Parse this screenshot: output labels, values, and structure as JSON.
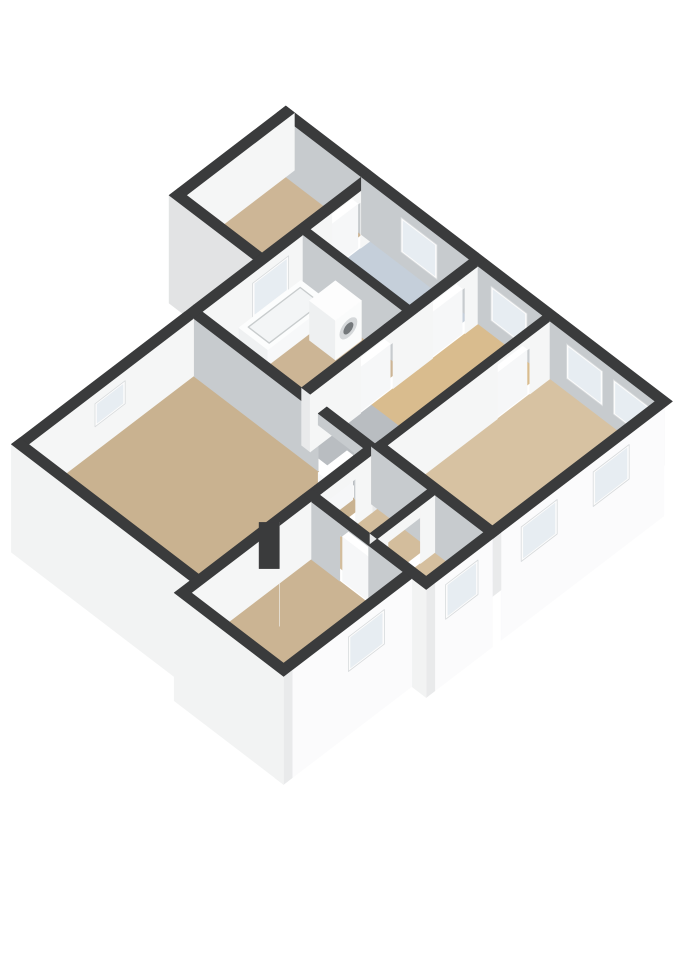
{
  "scene": {
    "width": 679,
    "height": 960,
    "projection": {
      "ox": 370,
      "oy": 228,
      "ax": 0.72,
      "ay": 0.55,
      "az": 0.72
    },
    "wall_height": 80,
    "slab_depth": 70,
    "door_height": 62,
    "colors": {
      "bg": "#ffffff",
      "top": "#3a3b3c",
      "innerGray": "#c7cbce",
      "innerWhite": "#f5f6f6",
      "extX": "#fbfbfc",
      "extY": "#f2f3f3",
      "aExt": "#e2e3e4",
      "cap": "#e9eaeb",
      "frame": "#fcfcfc",
      "glass": "#e7edf2",
      "tub": "#fcfdfd",
      "tubSide": "#eff1f2",
      "tubSideL": "#f7f8f9",
      "basin": "#f3f5f6",
      "basinLine": "#c8cccd",
      "washer": "#fafbfb",
      "washerSide": "#eef0f1",
      "washerTop": "#fdfdfd",
      "ring": "#d5d8da",
      "ringInner": "#74787b",
      "boxSide": "#f0f1f2",
      "boxSideL": "#f8f9f9",
      "boxTop": "#fdfdfd",
      "leafSide": "#f6f7f8",
      "leafTop": "#ffffff"
    },
    "floors": [
      {
        "name": "bedroom-top-left",
        "r": [
          -105,
          12,
          0,
          150
        ],
        "c": "#cdb696"
      },
      {
        "name": "bathroom-blue",
        "r": [
          12,
          12,
          150,
          95
        ],
        "c": "#c5cfda"
      },
      {
        "name": "bathroom-tub",
        "r": [
          12,
          105,
          150,
          245
        ],
        "c": "#ccb595"
      },
      {
        "name": "hallway-north",
        "r": [
          162,
          12,
          252,
          160
        ],
        "c": "#d9bc8e"
      },
      {
        "name": "landing-gray",
        "r": [
          162,
          160,
          252,
          245
        ],
        "c": "#b9bdc1"
      },
      {
        "name": "bedroom-right",
        "r": [
          262,
          12,
          408,
          238
        ],
        "c": "#d7c2a2"
      },
      {
        "name": "room-se-small-1",
        "r": [
          260,
          250,
          330,
          330
        ],
        "c": "#d3bd9c"
      },
      {
        "name": "room-se-small-2",
        "r": [
          340,
          250,
          408,
          330
        ],
        "c": "#d5bf9e"
      },
      {
        "name": "bedroom-bottom",
        "r": [
          260,
          342,
          388,
          508
        ],
        "c": "#cbb493"
      },
      {
        "name": "living-room",
        "r": [
          12,
          257,
          248,
          486
        ],
        "c": "#c9b290"
      }
    ],
    "walls": [
      {
        "n": "ne-wall-wing",
        "r": [
          -117,
          0,
          0,
          12
        ],
        "f": "innerGray"
      },
      {
        "n": "nw-wall-wing",
        "r": [
          -117,
          0,
          -105,
          150
        ],
        "f": "innerWhite"
      },
      {
        "n": "sw-wall-wing",
        "r": [
          -117,
          150,
          0,
          162
        ],
        "z": [
          -70,
          80
        ],
        "f": "aExt",
        "cap": true
      },
      {
        "n": "sw-wing-corner",
        "r": [
          0,
          150,
          12,
          162
        ],
        "f": "aExt"
      },
      {
        "n": "ne-wall-1",
        "r": [
          0,
          0,
          150,
          12
        ],
        "f": "innerGray",
        "win": [
          {
            "s": 55,
            "e": 105
          }
        ]
      },
      {
        "n": "ne-wall-j1",
        "r": [
          150,
          0,
          162,
          12
        ],
        "f": "innerGray"
      },
      {
        "n": "ne-wall-2",
        "r": [
          162,
          0,
          252,
          12
        ],
        "f": "innerGray",
        "win": [
          {
            "s": 180,
            "e": 230
          }
        ]
      },
      {
        "n": "ne-wall-j2",
        "r": [
          252,
          0,
          262,
          12
        ],
        "f": "innerGray"
      },
      {
        "n": "ne-wall-3",
        "r": [
          262,
          0,
          420,
          12
        ],
        "f": "innerGray",
        "win": [
          {
            "s": 285,
            "e": 335
          },
          {
            "s": 350,
            "e": 400
          }
        ]
      },
      {
        "n": "nw-wall-1",
        "r": [
          0,
          12,
          12,
          25
        ],
        "f": "innerWhite"
      },
      {
        "n": "nw-wall-door-header",
        "r": [
          0,
          25,
          12,
          65
        ],
        "z": [
          64,
          80
        ],
        "f": "innerWhite"
      },
      {
        "n": "nw-wall-2",
        "r": [
          0,
          65,
          12,
          95
        ],
        "f": "innerWhite"
      },
      {
        "n": "nw-wall-3",
        "r": [
          0,
          95,
          12,
          105
        ],
        "f": "innerWhite"
      },
      {
        "n": "nw-wall-4",
        "r": [
          0,
          105,
          12,
          245
        ],
        "f": "innerWhite",
        "win": [
          {
            "s": 125,
            "e": 175
          }
        ]
      },
      {
        "n": "nw-wall-5",
        "r": [
          0,
          245,
          12,
          257
        ],
        "f": "innerWhite"
      },
      {
        "n": "nw-wall-6",
        "r": [
          0,
          257,
          12,
          486
        ],
        "f": "innerWhite",
        "win": [
          {
            "s": 352,
            "e": 394,
            "z": [
              34,
              66
            ]
          }
        ]
      },
      {
        "n": "nw-wall-7",
        "r": [
          0,
          486,
          12,
          498
        ],
        "f": "innerWhite"
      },
      {
        "n": "se-wall-1",
        "r": [
          408,
          12,
          420,
          238
        ],
        "z": [
          -70,
          80
        ],
        "f": "extX",
        "win": [
          {
            "s": 60,
            "e": 110
          },
          {
            "s": 160,
            "e": 210
          }
        ]
      },
      {
        "n": "se-wall-j",
        "r": [
          408,
          238,
          420,
          250
        ],
        "z": [
          -70,
          80
        ],
        "f": "extX"
      },
      {
        "n": "se-wall-2",
        "r": [
          408,
          250,
          420,
          330
        ],
        "z": [
          -70,
          80
        ],
        "f": "extX",
        "win": [
          {
            "s": 270,
            "e": 315
          }
        ],
        "cap": true
      },
      {
        "n": "se-step-wall",
        "r": [
          400,
          330,
          420,
          342
        ],
        "z": [
          -70,
          80
        ],
        "f": "extY",
        "cap": true
      },
      {
        "n": "d-north-1",
        "r": [
          250,
          330,
          300,
          342
        ],
        "f": "innerGray"
      },
      {
        "n": "d-north-header",
        "r": [
          300,
          330,
          340,
          342
        ],
        "z": [
          64,
          80
        ],
        "f": "innerGray"
      },
      {
        "n": "d-north-2",
        "r": [
          340,
          330,
          400,
          342
        ],
        "f": "innerGray"
      },
      {
        "n": "d-east-wall",
        "r": [
          388,
          342,
          400,
          520
        ],
        "z": [
          -70,
          80
        ],
        "f": "extX",
        "win": [
          {
            "s": 380,
            "e": 430
          }
        ],
        "cap": true
      },
      {
        "n": "d-south-wall",
        "r": [
          248,
          508,
          400,
          520
        ],
        "z": [
          -70,
          80
        ],
        "f": "extY",
        "cap": true
      },
      {
        "n": "d-west-wall",
        "r": [
          248,
          342,
          260,
          508
        ],
        "f": "innerWhite"
      },
      {
        "n": "living-south-wall",
        "r": [
          0,
          486,
          260,
          498
        ],
        "z": [
          -70,
          80
        ],
        "f": "extY",
        "cap": true
      },
      {
        "n": "living-east-1",
        "r": [
          248,
          257,
          260,
          280
        ],
        "f": "innerWhite"
      },
      {
        "n": "living-east-header",
        "r": [
          248,
          280,
          260,
          325
        ],
        "z": [
          64,
          80
        ],
        "f": "innerWhite"
      },
      {
        "n": "living-east-2",
        "r": [
          248,
          325,
          260,
          342
        ],
        "f": "innerWhite"
      },
      {
        "n": "living-north-1",
        "r": [
          12,
          245,
          185,
          257
        ],
        "f": "innerGray"
      },
      {
        "n": "living-north-header",
        "r": [
          185,
          245,
          235,
          257
        ],
        "z": [
          64,
          80
        ],
        "f": "innerGray"
      },
      {
        "n": "living-north-2",
        "r": [
          235,
          245,
          260,
          257
        ],
        "f": "innerGray",
        "cap": true
      },
      {
        "n": "blue-bath-divider",
        "r": [
          12,
          95,
          150,
          105
        ],
        "f": "innerGray",
        "cap": true
      },
      {
        "n": "blue-east-1",
        "r": [
          150,
          12,
          162,
          30
        ],
        "f": "innerWhite"
      },
      {
        "n": "blue-east-header",
        "r": [
          150,
          30,
          162,
          75
        ],
        "z": [
          64,
          80
        ],
        "f": "innerWhite"
      },
      {
        "n": "blue-east-2",
        "r": [
          150,
          75,
          162,
          95
        ],
        "f": "innerWhite"
      },
      {
        "n": "bath-east-1",
        "r": [
          150,
          95,
          162,
          130
        ],
        "f": "innerWhite"
      },
      {
        "n": "bath-east-header",
        "r": [
          150,
          130,
          162,
          175
        ],
        "z": [
          64,
          80
        ],
        "f": "innerWhite"
      },
      {
        "n": "bath-east-2",
        "r": [
          150,
          175,
          162,
          245
        ],
        "f": "innerWhite",
        "cap": true
      },
      {
        "n": "hall-bedroom-1",
        "r": [
          252,
          12,
          262,
          40
        ],
        "f": "innerWhite"
      },
      {
        "n": "hall-bedroom-header",
        "r": [
          252,
          40,
          262,
          85
        ],
        "z": [
          64,
          80
        ],
        "f": "innerWhite"
      },
      {
        "n": "hall-bedroom-2",
        "r": [
          252,
          85,
          262,
          245
        ],
        "f": "innerWhite",
        "cap": true
      },
      {
        "n": "bedroom-south-wall",
        "r": [
          252,
          238,
          420,
          250
        ],
        "f": "innerGray",
        "cap": true
      },
      {
        "n": "se-rooms-divider-1",
        "r": [
          330,
          250,
          340,
          270
        ],
        "f": "innerWhite"
      },
      {
        "n": "se-rooms-divider-h",
        "r": [
          330,
          270,
          340,
          315
        ],
        "z": [
          64,
          80
        ],
        "f": "innerWhite"
      },
      {
        "n": "se-rooms-divider-2",
        "r": [
          330,
          315,
          340,
          330
        ],
        "f": "innerWhite",
        "cap": true
      },
      {
        "n": "stair-diagonal-wall",
        "poly": [
          [
            257,
            383
          ],
          [
            299,
            425
          ],
          [
            285,
            439
          ],
          [
            243,
            397
          ]
        ],
        "f": "innerWhite"
      }
    ],
    "fixtures": [
      {
        "n": "bathtub",
        "kind": "tub",
        "r": [
          14,
          110,
          54,
          196
        ],
        "h": 22
      },
      {
        "n": "washing-machine",
        "kind": "washer",
        "r": [
          60,
          108,
          96,
          144
        ],
        "h": 55
      },
      {
        "n": "storage-cabinet",
        "kind": "box",
        "r": [
          222,
          335,
          248,
          368
        ],
        "h": 30
      }
    ],
    "doors": [
      {
        "n": "door-wing-bedroom",
        "r": [
          2,
          27,
          10,
          63
        ]
      },
      {
        "n": "door-blue-bathroom",
        "r": [
          152,
          32,
          160,
          73
        ]
      },
      {
        "n": "door-bathroom",
        "r": [
          152,
          132,
          160,
          173
        ]
      },
      {
        "n": "door-bedroom-right",
        "r": [
          254,
          42,
          260,
          84
        ]
      },
      {
        "n": "door-living-room-open",
        "r": [
          227,
          259,
          235,
          299
        ]
      },
      {
        "n": "door-bedroom-bottom",
        "r": [
          302,
          332,
          338,
          340
        ]
      }
    ]
  }
}
